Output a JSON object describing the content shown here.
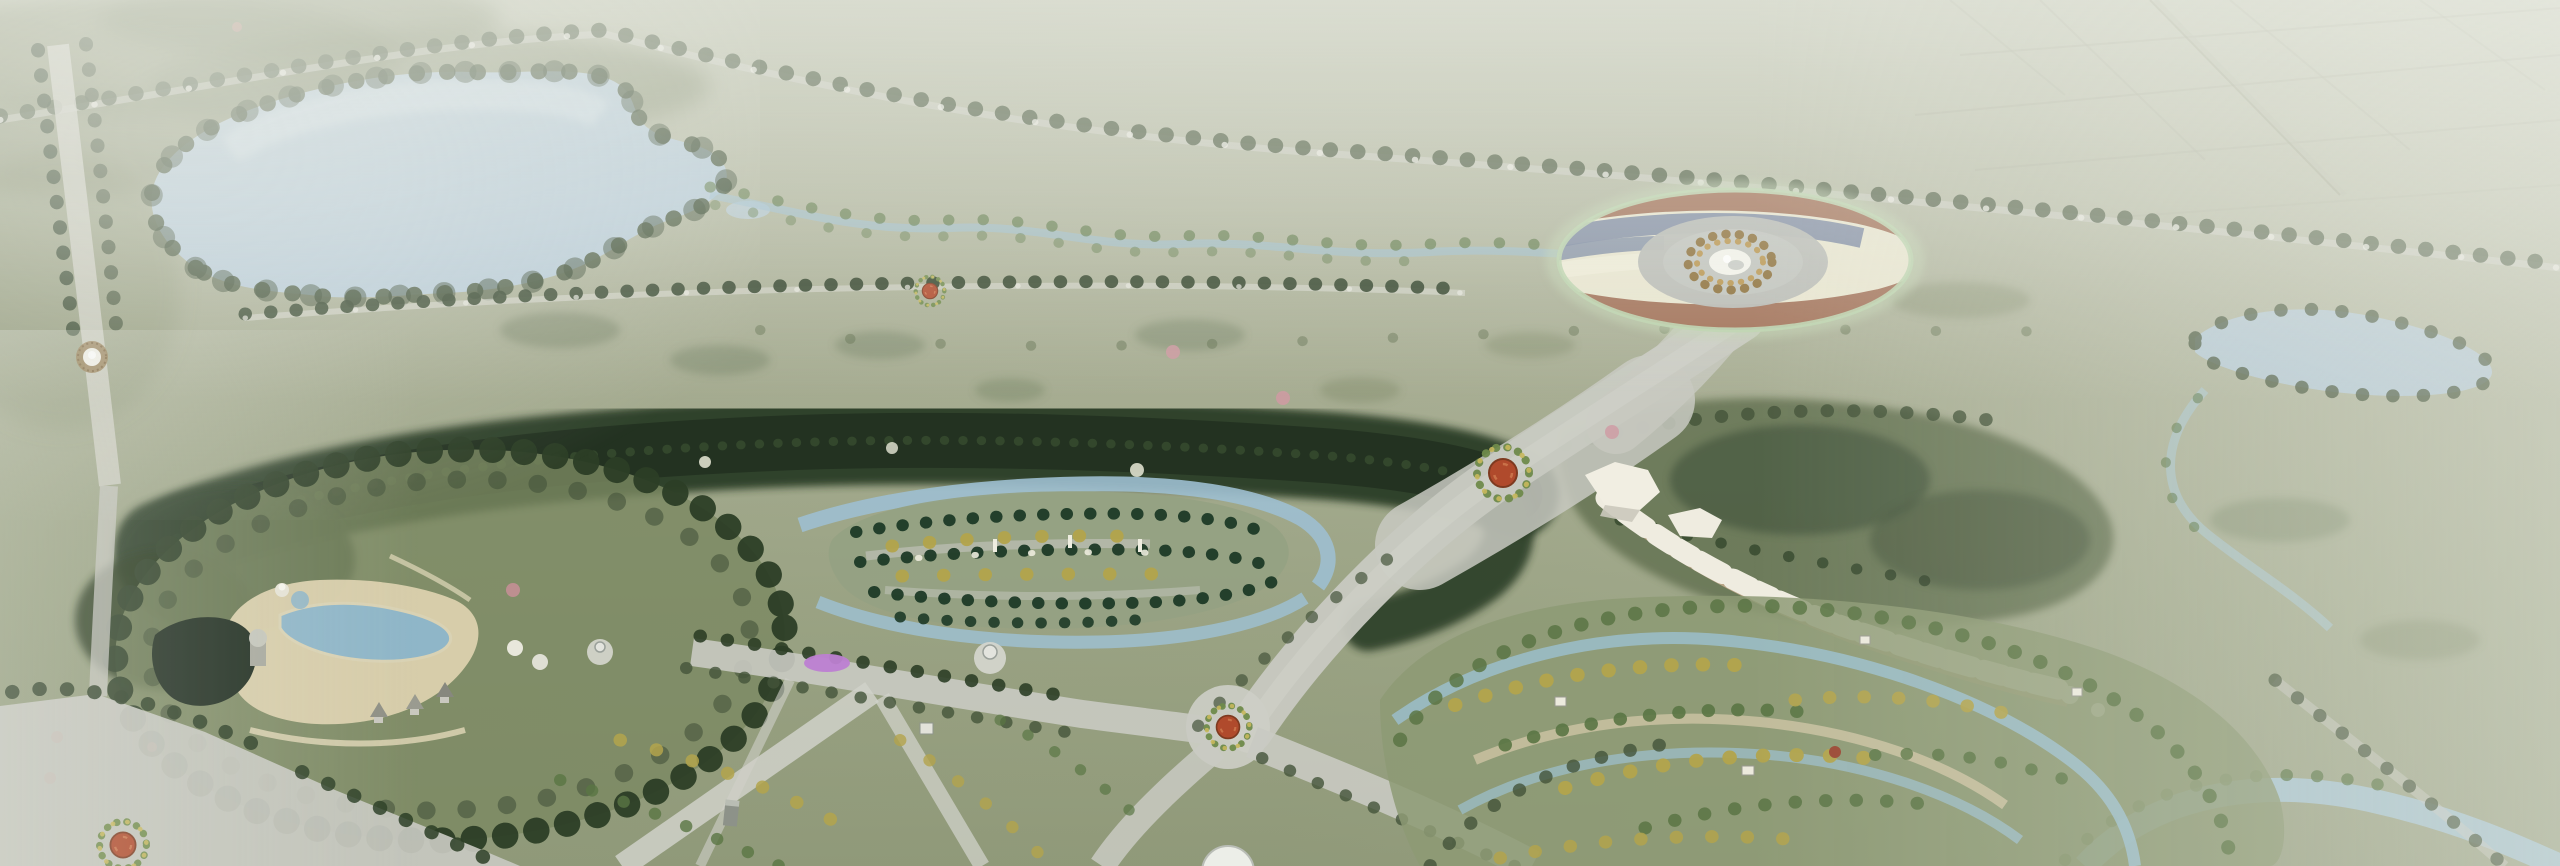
{
  "canvas": {
    "width": 2560,
    "height": 866
  },
  "scene": {
    "type": "aerial-park-masterplan-rendering",
    "view": "oblique-birds-eye",
    "atmosphere": "hazy-fog-top-and-right",
    "features": [
      {
        "name": "lake",
        "kind": "water",
        "position": "upper-left"
      },
      {
        "name": "shoreline-trees",
        "kind": "vegetation"
      },
      {
        "name": "farmland-grid",
        "kind": "fields",
        "position": "top-right"
      },
      {
        "name": "tree-avenue",
        "kind": "tree-lined-road",
        "position": "top"
      },
      {
        "name": "left-avenue",
        "kind": "tree-lined-road",
        "position": "left"
      },
      {
        "name": "avenue-fountain",
        "kind": "fountain",
        "position": "left"
      },
      {
        "name": "grand-circular-plaza",
        "kind": "plaza",
        "position": "upper-right",
        "pattern": "wavy-color-bands"
      },
      {
        "name": "plaza-fountain",
        "kind": "fountain",
        "position": "plaza-center"
      },
      {
        "name": "ornamental-ring",
        "kind": "paving",
        "position": "plaza-center"
      },
      {
        "name": "forest-belt",
        "kind": "dense-forest",
        "position": "center"
      },
      {
        "name": "formal-garden-island",
        "kind": "garden",
        "planting": "cypress-and-golden-trees"
      },
      {
        "name": "garden-obelisks",
        "kind": "sculpture"
      },
      {
        "name": "garden-rivers",
        "kind": "water-channel"
      },
      {
        "name": "activity-garden",
        "kind": "garden",
        "position": "left-center"
      },
      {
        "name": "sand-plaza",
        "kind": "plaza"
      },
      {
        "name": "garden-ponds",
        "kind": "water"
      },
      {
        "name": "dark-pond",
        "kind": "water"
      },
      {
        "name": "garden-pavilions",
        "kind": "building"
      },
      {
        "name": "grand-promenade",
        "kind": "road",
        "from": "circular-plaza",
        "to": "south-intersection"
      },
      {
        "name": "flower-roundabouts",
        "kind": "landmark",
        "count": 4
      },
      {
        "name": "crossroads",
        "kind": "road-intersection"
      },
      {
        "name": "white-rock-arc",
        "kind": "rockery",
        "position": "right-center"
      },
      {
        "name": "forest-hill",
        "kind": "woodland",
        "position": "right-of-promenade"
      },
      {
        "name": "orchard-garden",
        "kind": "garden",
        "position": "bottom-right"
      },
      {
        "name": "orchard-water-loop",
        "kind": "water-channel"
      },
      {
        "name": "right-pond",
        "kind": "water",
        "position": "right"
      },
      {
        "name": "bottom-river",
        "kind": "water",
        "position": "bottom-right"
      },
      {
        "name": "magenta-flowerbed",
        "kind": "planting"
      },
      {
        "name": "white-gazebos",
        "kind": "building"
      },
      {
        "name": "bottom-dome",
        "kind": "building",
        "position": "bottom-center"
      },
      {
        "name": "haze-overlay",
        "kind": "atmosphere"
      }
    ]
  },
  "colors": {
    "haze_white": "#e9ebe3",
    "ground_top": "#c6cab8",
    "ground_mid": "#a3ab8e",
    "ground_low": "#8e9877",
    "meadow_dark": "#6f7d5e",
    "lake_water": "#b5cad7",
    "lake_water_light": "#d6e3e9",
    "stream_water": "#9dbfd0",
    "river_water": "#aac8d6",
    "tree_dark": "#2c3e26",
    "tree_mid": "#44543a",
    "tree_bright": "#5a7644",
    "tree_gold": "#b3a44c",
    "tree_cypress": "#1d3a27",
    "tree_pink": "#cf9aa2",
    "forest_belt": "#2c3e26",
    "forest_hill": "#5d6c4c",
    "garden_green": "#95a183",
    "orchard_green": "#8d9a74",
    "road_gray": "#c8c9c1",
    "road_light": "#d6d7d0",
    "path_sand": "#ded5b5",
    "sand_plaza": "#dcd2ae",
    "dark_pond": "#202e21",
    "plaza_cream": "#e9e6d0",
    "plaza_terracotta": "#a3735a",
    "plaza_slate": "#7d8aa2",
    "plaza_rim_green": "#bcd4ae",
    "plaza_center_gray": "#b9bbb6",
    "plaza_gold_ring": "#8a6c34",
    "fountain_white": "#f4f4ec",
    "medallion_red": "#b04a2c",
    "flowerbed_magenta": "#bd7fd2",
    "rock_white": "#efece0",
    "rock_path_tan": "#c7ad8e",
    "farmland_line": "#a9ac99",
    "monument_gray": "#8d9289"
  }
}
